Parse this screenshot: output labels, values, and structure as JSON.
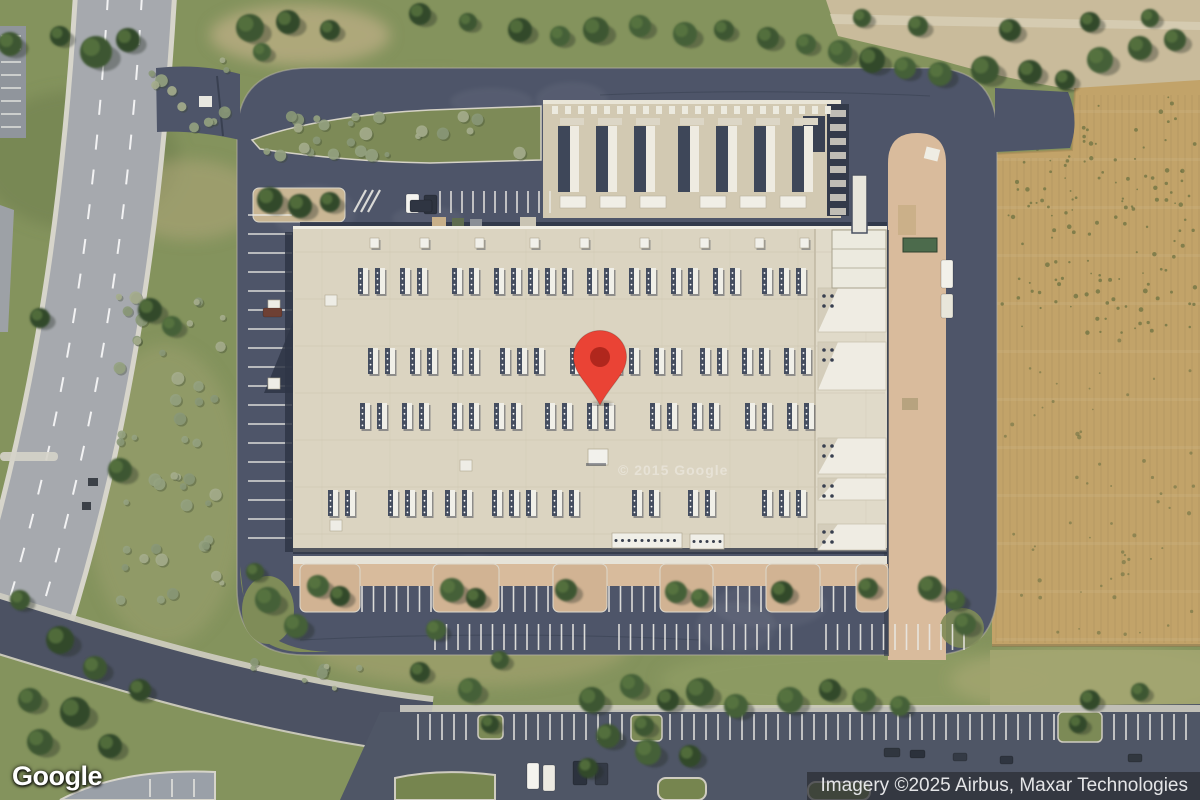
{
  "branding": {
    "logo_text": "Google"
  },
  "attribution": {
    "text": "Imagery ©2025 Airbus, Maxar Technologies"
  },
  "watermark": {
    "text": "© 2015 Google"
  },
  "map": {
    "view_type": "satellite",
    "pin": {
      "color": "#EA4335",
      "inner_color": "#B0271D"
    }
  }
}
